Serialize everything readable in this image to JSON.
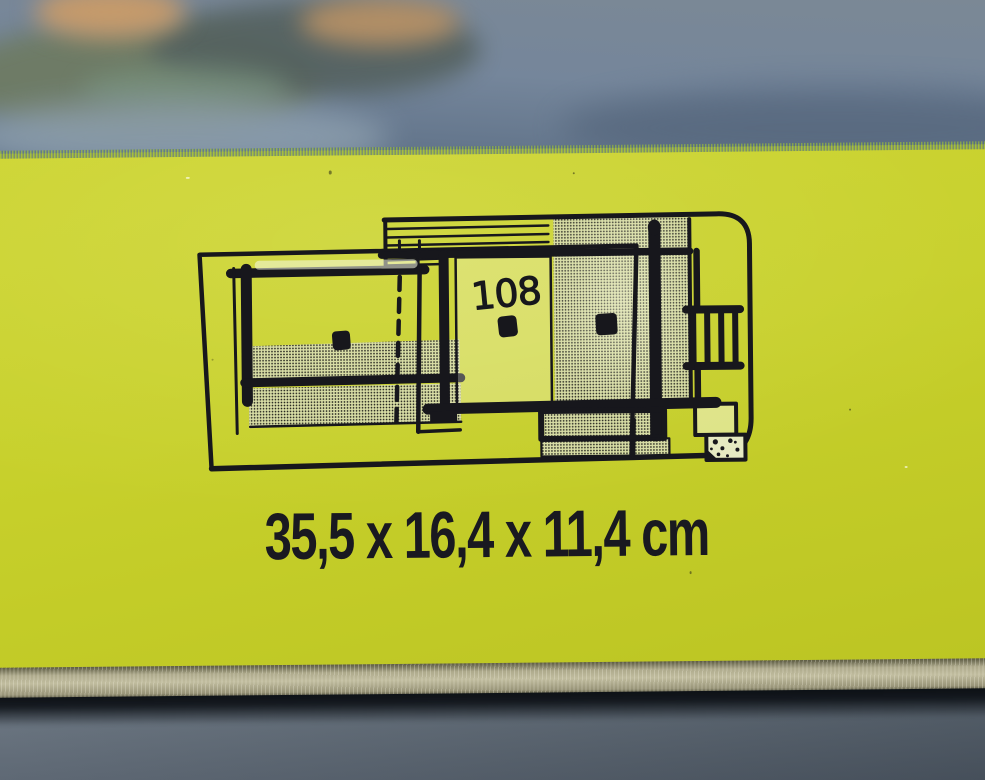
{
  "photo": {
    "panel": {
      "model_number": "108",
      "dimensions_text": "35,5 x 16,4 x 11,4 cm",
      "background_color": "#c7d02b",
      "ink_color": "#17171c",
      "diagram_icon": "film-viewer-side-view-diagram"
    },
    "backdrop": {
      "color": "#75869b"
    },
    "box_edge": {
      "color": "#b3af92"
    },
    "shadow": {
      "color": "#0a0e13"
    },
    "table": {
      "color": "#87939f"
    }
  }
}
